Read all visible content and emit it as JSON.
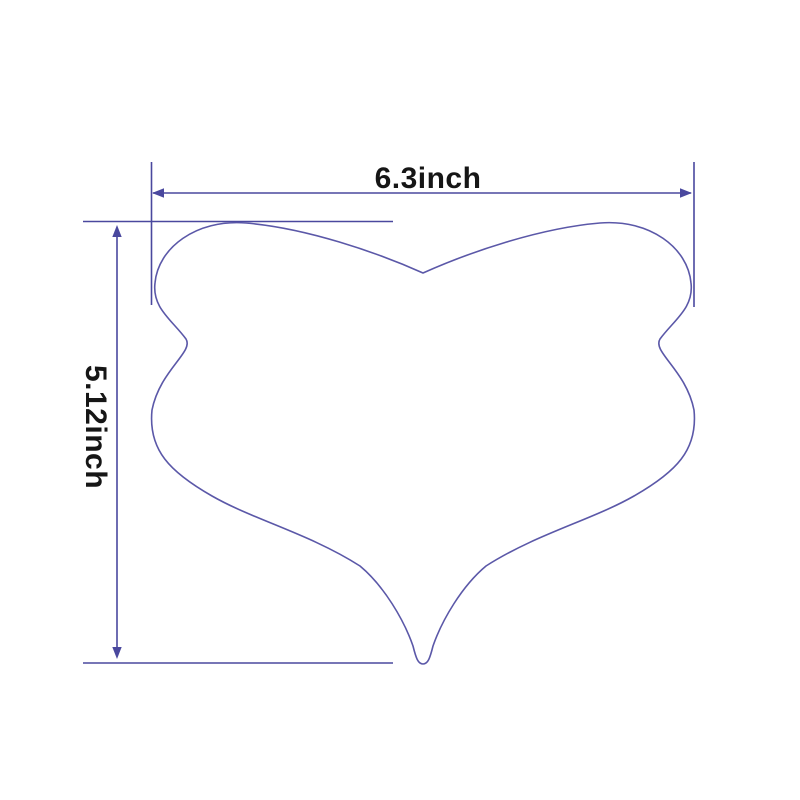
{
  "title": "Product dimension diagram",
  "colors": {
    "background": "#ffffff",
    "shape_outline": "#5b58a8",
    "dimension": "#4a489e",
    "text": "#161616"
  },
  "shape": {
    "name": "heart-shaped-tool-outline"
  },
  "dimensions": {
    "width": {
      "label": "6.3inch",
      "value": 6.3,
      "unit": "inch"
    },
    "height": {
      "label": "5.12inch",
      "value": 5.12,
      "unit": "inch"
    }
  }
}
